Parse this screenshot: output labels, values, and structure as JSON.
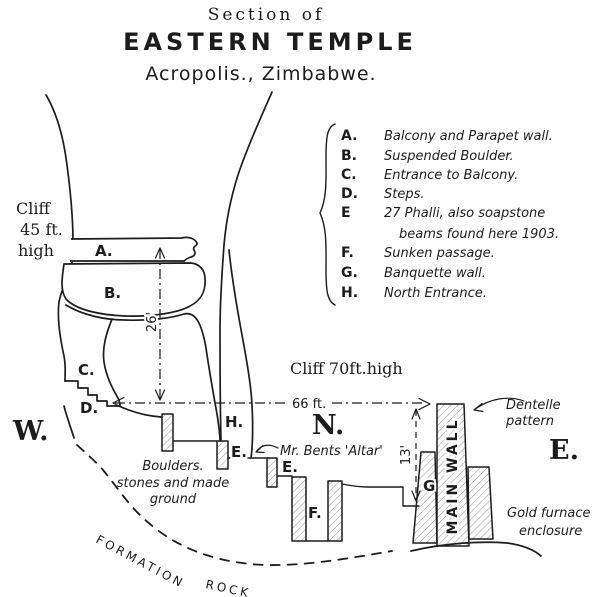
{
  "title": {
    "line1": "Section of",
    "line2": "EASTERN TEMPLE",
    "line3": "Acropolis., Zimbabwe."
  },
  "legend": {
    "items": [
      {
        "key": "A.",
        "desc": "Balcony and Parapet wall."
      },
      {
        "key": "B.",
        "desc": "Suspended Boulder."
      },
      {
        "key": "C.",
        "desc": "Entrance to Balcony."
      },
      {
        "key": "D.",
        "desc": "Steps."
      },
      {
        "key": "E",
        "desc": "27 Phalli, also soapstone",
        "desc2": "beams found here 1903."
      },
      {
        "key": "F.",
        "desc": "Sunken passage."
      },
      {
        "key": "G.",
        "desc": "Banquette wall."
      },
      {
        "key": "H.",
        "desc": "North Entrance."
      }
    ]
  },
  "annotations": {
    "cliff_west": {
      "line1": "Cliff",
      "line2": "45 ft.",
      "line3": "high"
    },
    "cliff_north": "Cliff 70ft.high",
    "compass": {
      "west": "W.",
      "north": "N.",
      "east": "E."
    },
    "dimensions": {
      "d26": "26'",
      "d66": "66 ft.",
      "d13": "13'"
    },
    "boulders": {
      "line1": "Boulders.",
      "line2": "stones and made",
      "line3": "ground"
    },
    "altar": "Mr. Bents 'Altar'",
    "dentelle": {
      "line1": "Dentelle",
      "line2": "pattern"
    },
    "gold": {
      "line1": "Gold furnace",
      "line2": "enclosure"
    },
    "main_wall": "MAIN WALL",
    "formation_rock": {
      "word1": "FORMATION",
      "word2": "ROCK"
    },
    "point_labels": {
      "a": "A.",
      "b": "B.",
      "c": "C.",
      "d": "D.",
      "h": "H.",
      "e_upper": "E.",
      "e_lower": "E.",
      "f": "F.",
      "g": "G"
    }
  },
  "colors": {
    "ink": "#1c1c1c",
    "paper": "#ffffff",
    "hatch": "#9a9a9a"
  }
}
